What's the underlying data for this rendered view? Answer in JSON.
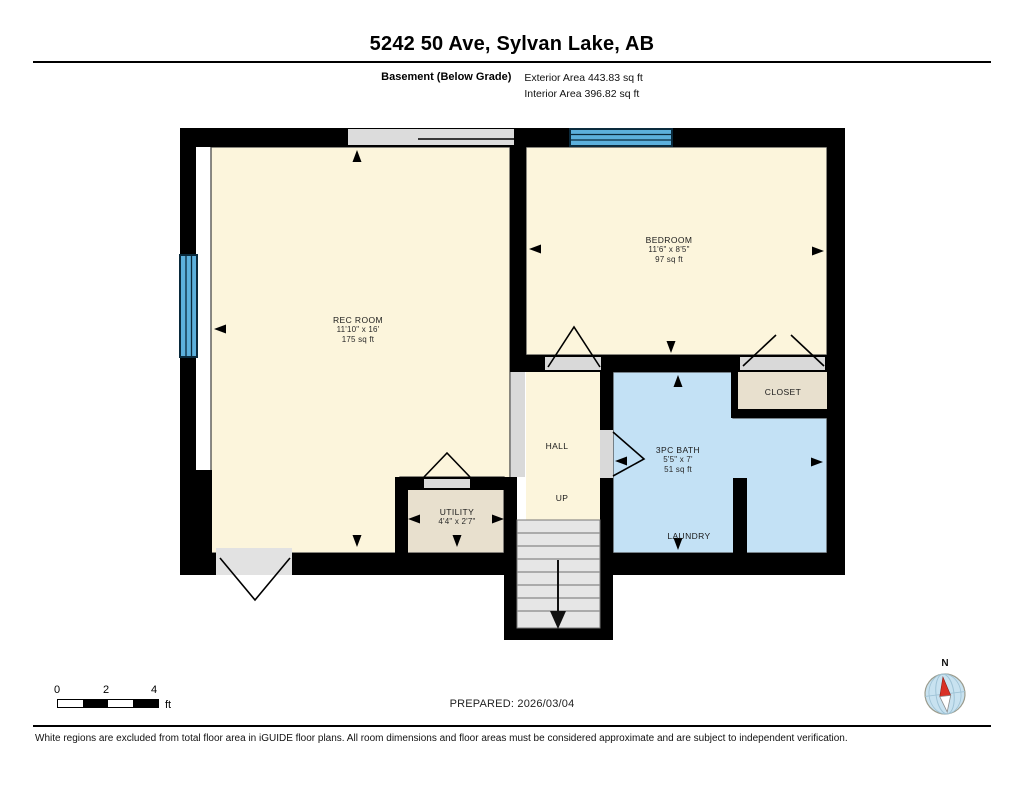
{
  "header": {
    "title": "5242 50 Ave, Sylvan Lake, AB",
    "floor_label": "Basement (Below Grade)",
    "exterior_area": "Exterior Area 443.83 sq ft",
    "interior_area": "Interior Area 396.82 sq ft"
  },
  "rooms": {
    "rec_room": {
      "name": "REC ROOM",
      "dims": "11'10\" x 16'",
      "area": "175 sq ft"
    },
    "bedroom": {
      "name": "BEDROOM",
      "dims": "11'6\" x 8'5\"",
      "area": "97 sq ft"
    },
    "bath": {
      "name": "3PC BATH",
      "dims": "5'5\" x 7'",
      "area": "51 sq ft"
    },
    "utility": {
      "name": "UTILITY",
      "dims": "4'4\" x 2'7\""
    },
    "closet": {
      "name": "CLOSET"
    },
    "hall": {
      "name": "HALL"
    },
    "laundry": {
      "name": "LAUNDRY"
    },
    "stairs": {
      "direction_label": "UP"
    }
  },
  "footer": {
    "scale_ticks": [
      "0",
      "2",
      "4"
    ],
    "scale_unit": "ft",
    "prepared": "PREPARED: 2026/03/04",
    "compass": "N",
    "disclaimer": "White regions are excluded from total floor area in iGUIDE floor plans. All room dimensions and floor areas must be considered approximate and are subject to independent verification."
  },
  "colors": {
    "room_fill": "#FCF5DC",
    "secondary_fill": "#E8E0CE",
    "bath_fill": "#C3E1F5",
    "window_fill": "#5CB0DC",
    "wall": "#000000"
  }
}
